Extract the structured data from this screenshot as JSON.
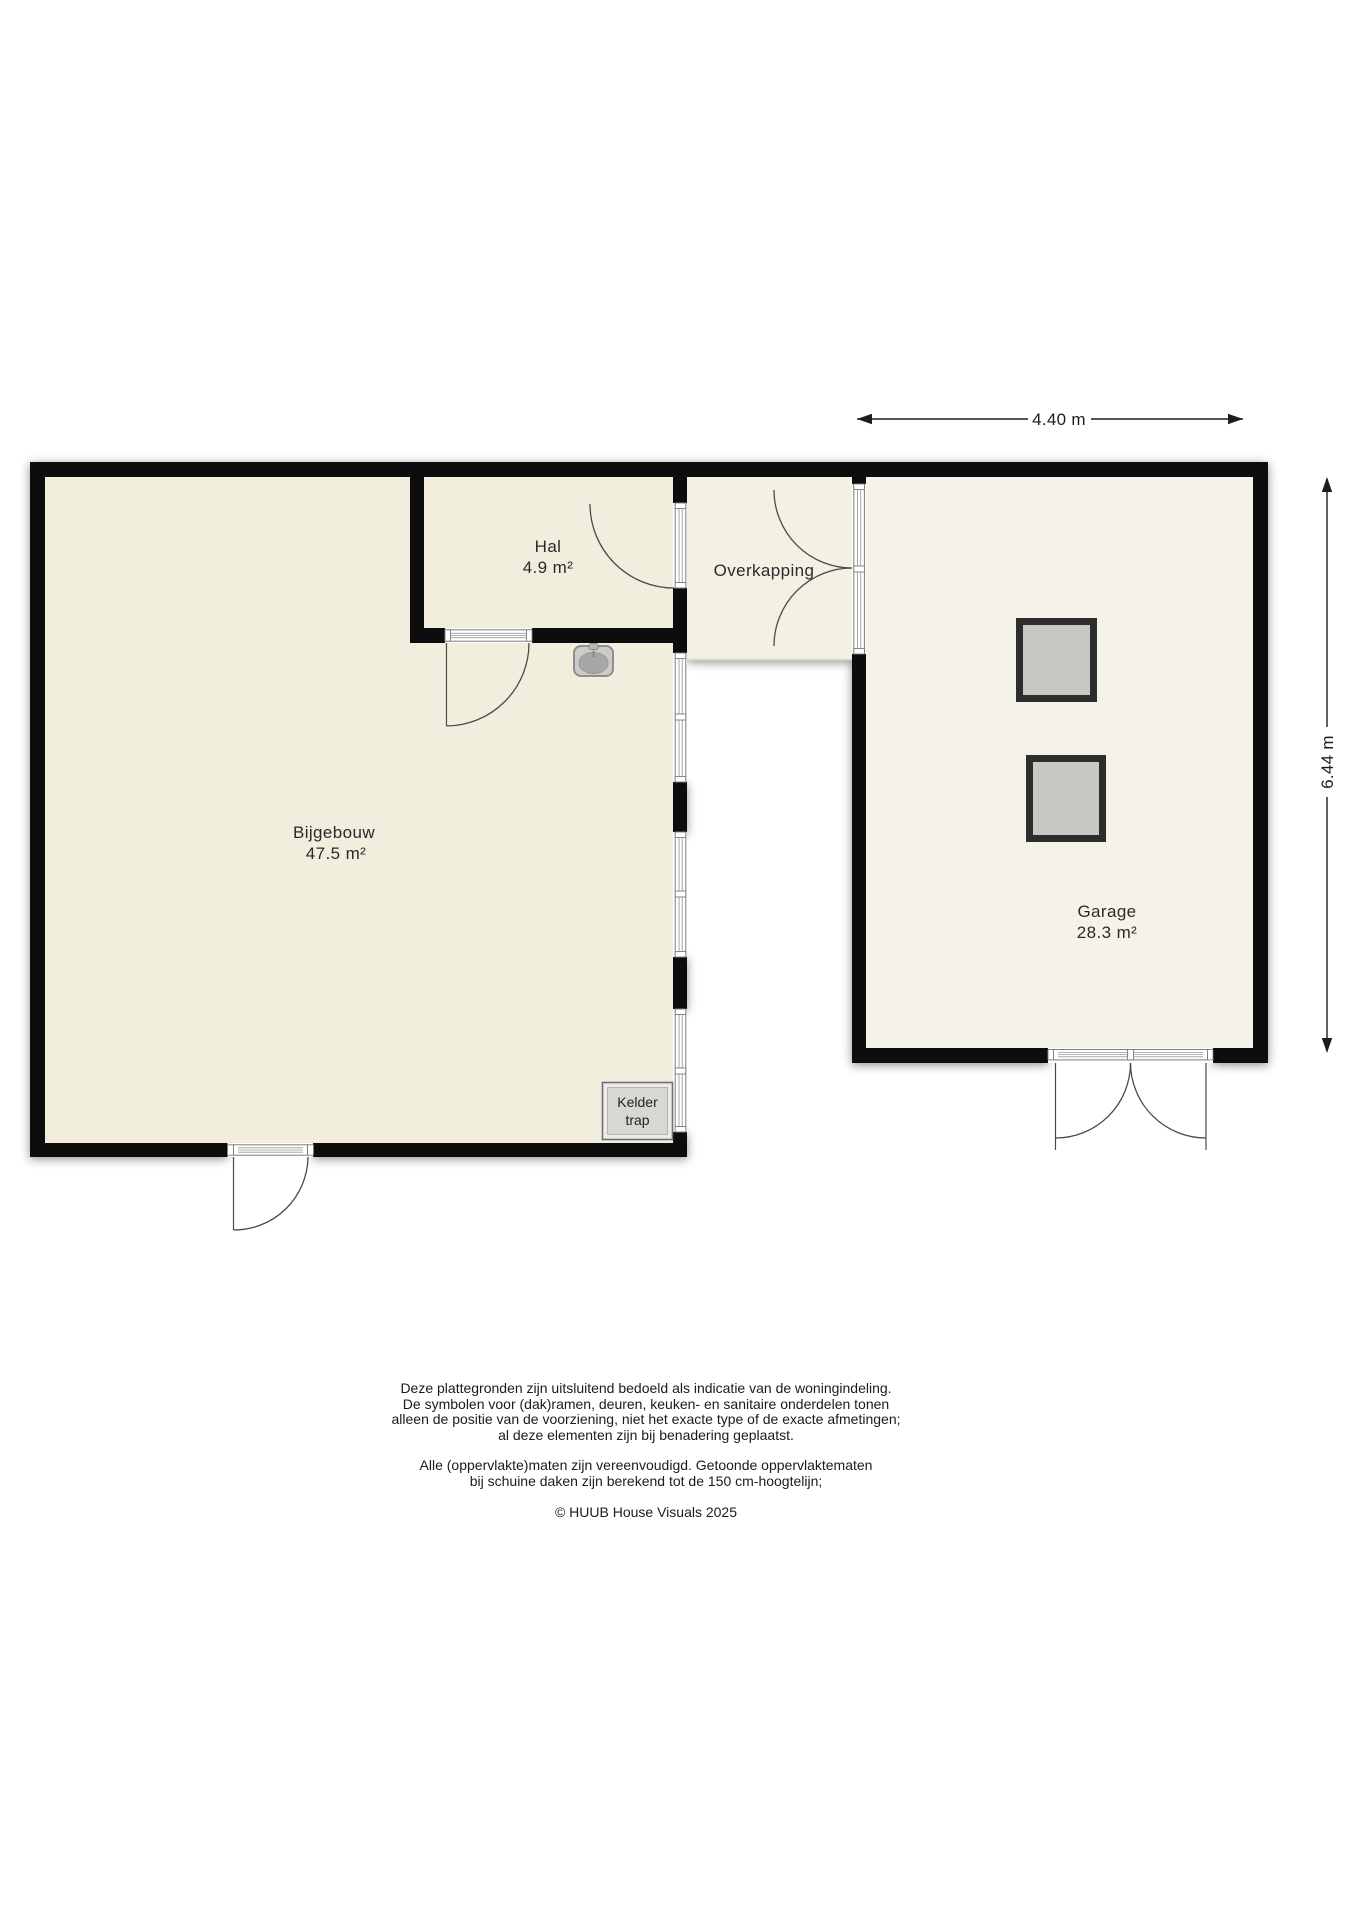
{
  "rooms": {
    "bijgebouw": {
      "name": "Bijgebouw",
      "area": "47.5 m²"
    },
    "hal": {
      "name": "Hal",
      "area": "4.9 m²"
    },
    "overkapping": {
      "name": "Overkapping"
    },
    "garage": {
      "name": "Garage",
      "area": "28.3 m²"
    },
    "kelder": {
      "line1": "Kelder",
      "line2": "trap"
    }
  },
  "dimensions": {
    "horizontal": "4.40 m",
    "vertical": "6.44 m"
  },
  "footer": {
    "disclaimer": [
      "Deze plattegronden zijn uitsluitend bedoeld als indicatie van de woningindeling.",
      "De symbolen voor (dak)ramen, deuren, keuken- en sanitaire onderdelen tonen",
      "alleen de positie van de voorziening, niet het exacte type of de exacte afmetingen;",
      "al deze elementen zijn bij benadering geplaatst."
    ],
    "measurements": [
      "Alle (oppervlakte)maten zijn vereenvoudigd. Getoonde oppervlaktematen",
      "bij schuine daken zijn berekend tot de 150 cm-hoogtelijn;"
    ],
    "copyright": "© HUUB House Visuals 2025"
  },
  "colors": {
    "wall": "#0f0f0f",
    "floor": "#f1eedd",
    "floor_overkapping": "#f3f1e4",
    "floor_garage": "#f5f3e9",
    "skylight_fill": "#c9c7c1",
    "line": "#4a4a4a"
  }
}
